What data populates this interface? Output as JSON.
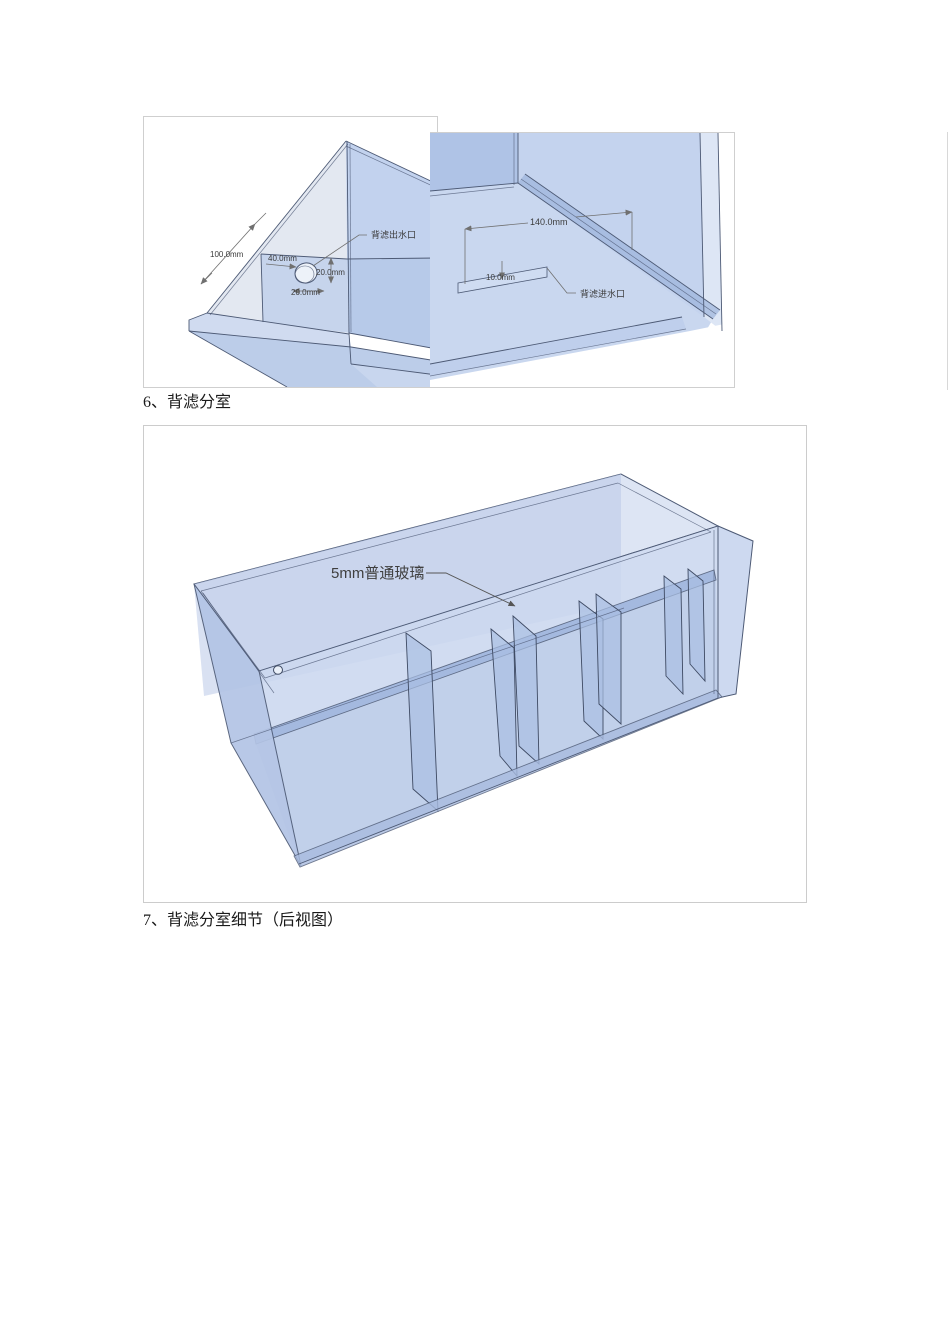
{
  "captions": {
    "section6": "6、背滤分室",
    "section7": "7、背滤分室细节（后视图）"
  },
  "figures": {
    "outlet": {
      "label": "背滤出水口",
      "dims": {
        "depth": "100.0mm",
        "offset": "40.0mm",
        "height": "20.0mm",
        "diameter": "20.0mm"
      }
    },
    "inlet": {
      "label": "背滤进水口",
      "dims": {
        "width": "140.0mm",
        "gap": "10.0mm"
      }
    },
    "compartments": {
      "glass_label": "5mm普通玻璃"
    }
  },
  "colors": {
    "glass_light": "#dde5f4",
    "glass_mid": "#c9d6ef",
    "glass_dark": "#b3c4e5",
    "cad_edge": "#4d5a75",
    "figure_border": "#cccccc"
  }
}
